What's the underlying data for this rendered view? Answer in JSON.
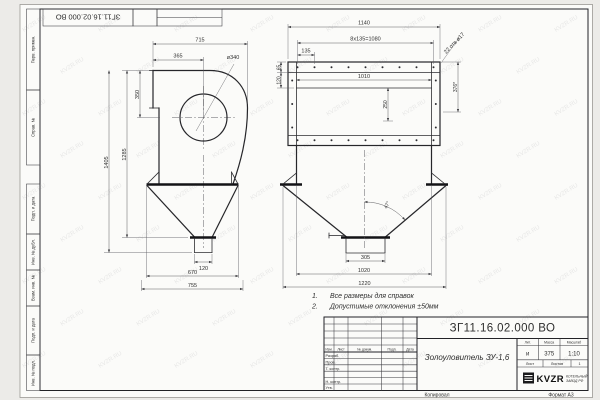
{
  "sheet": {
    "stamp_doc_number": "ЗГ11.16.02.000 ВО",
    "margin_labels": [
      "Перв. примен.",
      "Справ. №",
      "Подп. и дата",
      "Инв. № дубл.",
      "Взам. инв. №",
      "Подп. и дата",
      "Инв. № подл."
    ],
    "footer": {
      "copied": "Копировал",
      "format": "Формат А3"
    },
    "watermark": "KVZR.RU"
  },
  "notes": {
    "n1_num": "1.",
    "n1_text": "Все размеры для справок",
    "n2_num": "2.",
    "n2_text": "Допустимые отклонения ±50мм"
  },
  "views": {
    "side": {
      "dims": {
        "width_top": "715",
        "inlet_offset": "365",
        "inlet_dia": "ø340",
        "inlet_height": "350",
        "height_total": "1405",
        "height_body": "1285",
        "outlet_width": "120",
        "hopper_width": "670",
        "overall_width": "755"
      }
    },
    "front": {
      "dims": {
        "overall_width": "1140",
        "bolt_pattern": "8x135=1080",
        "bolt_step": "135",
        "holes_note": "22 отв ø17",
        "flange_offset": "65",
        "duct_offset": "120",
        "inner_width": "1010",
        "inner_height": "250",
        "height_ref": "376*",
        "cone_angle": "47°",
        "outlet_width": "305",
        "support_span": "1020",
        "overall_bottom": "1220"
      }
    }
  },
  "title_block": {
    "doc_number": "ЗГ11.16.02.000 ВО",
    "name": "Золоуловитель ЗУ-1,6",
    "header_cols": [
      "Изм.",
      "Лист",
      "№ докум.",
      "Подп.",
      "Дата"
    ],
    "sig_rows": [
      "Разраб.",
      "Пров.",
      "Т. контр.",
      "Н. контр.",
      "Утв."
    ],
    "lit_label": "Лит.",
    "mass_label": "Масса",
    "scale_label": "Масштаб",
    "lit_value": "и",
    "mass_value": "375",
    "scale_value": "1:10",
    "sheet_label": "Лист",
    "sheets_label": "Листов",
    "sheets_value": "1",
    "logo_text": "KVZR",
    "logo_sub1": "КОТЕЛЬНЫЙ",
    "logo_sub2": "ЗАВОД РФ"
  }
}
